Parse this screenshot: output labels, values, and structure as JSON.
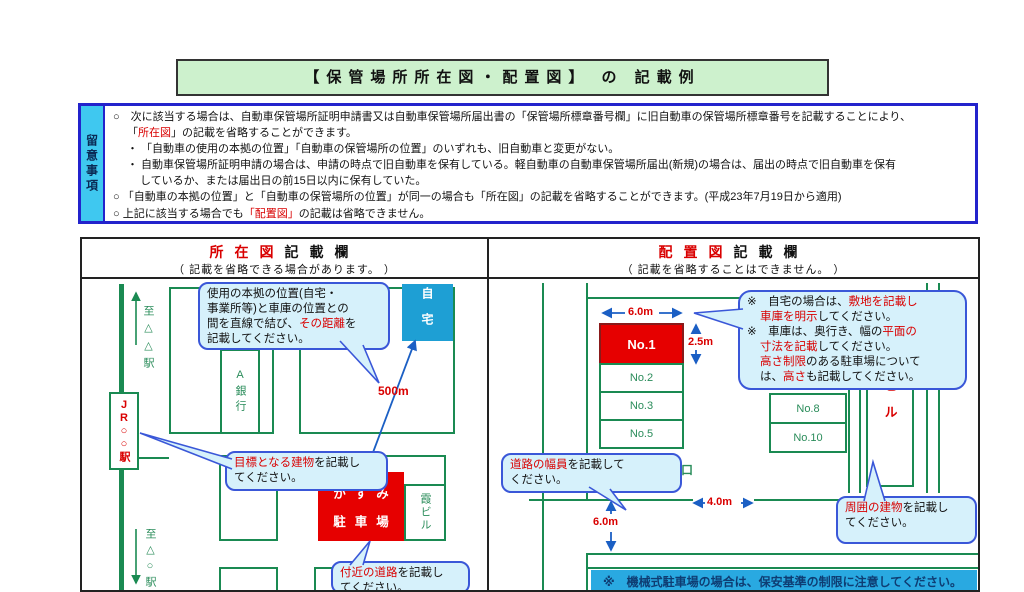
{
  "colors": {
    "accent_green": "#1a8a52",
    "accent_red": "#d90000",
    "box_red": "#e60000",
    "home_blue": "#1e9fd4",
    "callout_fill": "#d6f1fb",
    "callout_border": "#3a57d8",
    "note_border_blue": "#2323cc",
    "note_strip_cyan": "#3fc8f0",
    "title_green_bg": "#cdf1cd",
    "banner_cyan": "#29a9e1",
    "arrow_blue": "#1b5fc4"
  },
  "title": "【保管場所所在図・配置図】 の 記載例",
  "notes": {
    "label": "留意事項",
    "lines": [
      {
        "ind": 0,
        "seg": [
          {
            "t": "○　次に該当する場合は、自動車保管場所証明申請書又は自動車保管場所届出書の「保管場所標章番号欄」に旧自動車の保管場所標章番号を記載することにより、"
          }
        ]
      },
      {
        "ind": 1,
        "seg": [
          {
            "t": "「"
          },
          {
            "t": "所在図",
            "r": true
          },
          {
            "t": "」の記載を省略することができます。"
          }
        ]
      },
      {
        "ind": 1,
        "seg": [
          {
            "t": "・ 「自動車の使用の本拠の位置」「自動車の保管場所の位置」のいずれも、旧自動車と変更がない。"
          }
        ]
      },
      {
        "ind": 1,
        "seg": [
          {
            "t": "・ 自動車保管場所証明申請の場合は、申請の時点で旧自動車を保有している。軽自動車の自動車保管場所届出(新規)の場合は、届出の時点で旧自動車を保有"
          }
        ]
      },
      {
        "ind": 2,
        "seg": [
          {
            "t": "しているか、または届出日の前15日以内に保有していた。"
          }
        ]
      },
      {
        "ind": 0,
        "seg": [
          {
            "t": "○ 「自動車の本拠の位置」と「自動車の保管場所の位置」が同一の場合も「所在図」の記載を省略することができます。(平成23年7月19日から適用)"
          }
        ]
      },
      {
        "ind": 0,
        "seg": [
          {
            "t": "○ 上記に該当する場合でも"
          },
          {
            "t": "「配置図」",
            "r": true
          },
          {
            "t": "の記載は省略できません。"
          }
        ]
      }
    ]
  },
  "left_panel": {
    "title_red": "所在図",
    "title_rest": "記載欄",
    "subtitle": "（ 記載を省略できる場合があります。 ）",
    "map": {
      "to_top": "至△△駅",
      "to_bottom": "至△○駅",
      "station": "JR○○駅",
      "bank": "A銀行",
      "home": "自宅",
      "distance": "500m",
      "parking1": "かすみ",
      "parking2": "駐車場",
      "building": "霞ビル",
      "callout_distance": [
        {
          "ind": 0,
          "seg": [
            {
              "t": "使用の本拠の位置(自宅・"
            }
          ]
        },
        {
          "ind": 0,
          "seg": [
            {
              "t": "事業所等)と車庫の位置との"
            }
          ]
        },
        {
          "ind": 0,
          "seg": [
            {
              "t": "間を直線で結び、"
            },
            {
              "t": "その距離",
              "r": true
            },
            {
              "t": "を"
            }
          ]
        },
        {
          "ind": 0,
          "seg": [
            {
              "t": "記載してください。"
            }
          ]
        }
      ],
      "callout_landmark": [
        {
          "ind": 0,
          "seg": [
            {
              "t": "目標となる建物",
              "r": true
            },
            {
              "t": "を記載し"
            }
          ]
        },
        {
          "ind": 0,
          "seg": [
            {
              "t": "てください。"
            }
          ]
        }
      ],
      "callout_roads": [
        {
          "ind": 0,
          "seg": [
            {
              "t": "付近の道路",
              "r": true
            },
            {
              "t": "を記載し"
            }
          ]
        },
        {
          "ind": 0,
          "seg": [
            {
              "t": "てください。"
            }
          ]
        }
      ]
    }
  },
  "right_panel": {
    "title_red": "配置図",
    "title_rest": "記載欄",
    "subtitle": "（ 記載を省略することはできません。 ）",
    "map": {
      "stalls_left": [
        "No.1",
        "No.2",
        "No.3",
        "No.5"
      ],
      "stalls_right": [
        "No.8",
        "No.10"
      ],
      "building": "霞ビル",
      "entrance": "出入口",
      "street": "○ ○通り",
      "dims": {
        "width_top": "6.0m",
        "depth": "2.5m",
        "gate": "4.0m",
        "road": "6.0m"
      },
      "callout_home": [
        {
          "ind": 0,
          "seg": [
            {
              "t": "※　自宅の場合は、"
            },
            {
              "t": "敷地を記載し",
              "r": true
            }
          ]
        },
        {
          "ind": 1,
          "seg": [
            {
              "t": "車庫を明示",
              "r": true
            },
            {
              "t": "してください。"
            }
          ]
        },
        {
          "ind": 0,
          "seg": [
            {
              "t": "※　車庫は、奥行き、幅の"
            },
            {
              "t": "平面の",
              "r": true
            }
          ]
        },
        {
          "ind": 1,
          "seg": [
            {
              "t": "寸法を記載",
              "r": true
            },
            {
              "t": "してください。"
            }
          ]
        },
        {
          "ind": 1,
          "seg": [
            {
              "t": "高さ制限",
              "r": true
            },
            {
              "t": "のある駐車場について"
            }
          ]
        },
        {
          "ind": 1,
          "seg": [
            {
              "t": "は、"
            },
            {
              "t": "高さ",
              "r": true
            },
            {
              "t": "も記載してください。"
            }
          ]
        }
      ],
      "callout_road_width": [
        {
          "ind": 0,
          "seg": [
            {
              "t": "道路の幅員",
              "r": true
            },
            {
              "t": "を記載して"
            }
          ]
        },
        {
          "ind": 0,
          "seg": [
            {
              "t": "ください。"
            }
          ]
        }
      ],
      "callout_surroundings": [
        {
          "ind": 0,
          "seg": [
            {
              "t": "周囲の建物",
              "r": true
            },
            {
              "t": "を記載し"
            }
          ]
        },
        {
          "ind": 0,
          "seg": [
            {
              "t": "てください。"
            }
          ]
        }
      ],
      "banner": "※　機械式駐車場の場合は、保安基準の制限に注意してください。"
    }
  }
}
